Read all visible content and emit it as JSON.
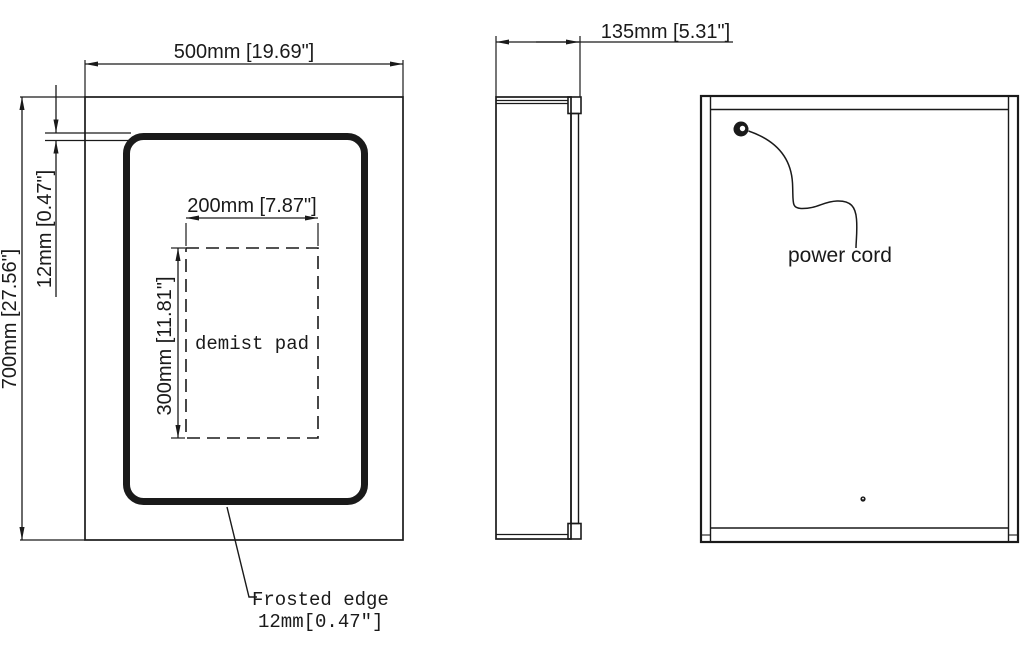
{
  "front_view": {
    "width_dim": "500mm [19.69\"]",
    "height_dim": "700mm [27.56\"]",
    "edge_dim": "12mm [0.47\"]",
    "demist_width_dim": "200mm [7.87\"]",
    "demist_height_dim": "300mm [11.81\"]",
    "demist_label": "demist pad",
    "note_line1": "Frosted edge",
    "note_line2": "12mm[0.47″]"
  },
  "side_view": {
    "depth_dim": "135mm [5.31\"]"
  },
  "back_view": {
    "cord_label": "power cord"
  },
  "colors": {
    "line": "#1a1a1a",
    "background": "#ffffff"
  }
}
